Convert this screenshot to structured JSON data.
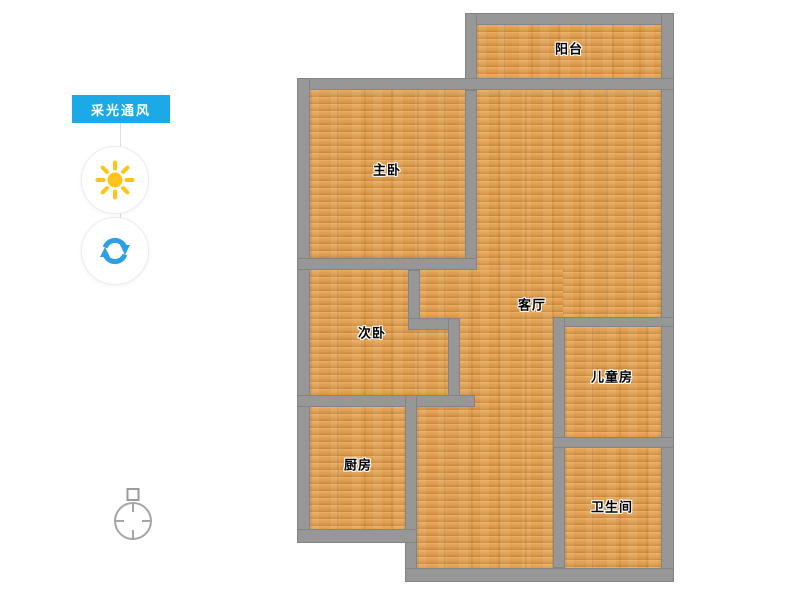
{
  "panel": {
    "badge_label": "采光通风",
    "buttons": [
      {
        "name": "daylight",
        "icon": "sun-icon"
      },
      {
        "name": "ventilation-refresh",
        "icon": "refresh-icon"
      }
    ]
  },
  "compass": {
    "icon": "compass-icon"
  },
  "floorplan": {
    "rooms": [
      {
        "label": "阳台"
      },
      {
        "label": "主卧"
      },
      {
        "label": "客厅"
      },
      {
        "label": "次卧"
      },
      {
        "label": "儿童房"
      },
      {
        "label": "厨房"
      },
      {
        "label": "卫生间"
      }
    ]
  },
  "colors": {
    "badge_bg": "#1ba9e8",
    "wall": "#979797",
    "floor": "#e0a050",
    "sun": "#ffc41a",
    "refresh_arrows": "#2e9ee5",
    "compass": "#a0a0a0"
  }
}
